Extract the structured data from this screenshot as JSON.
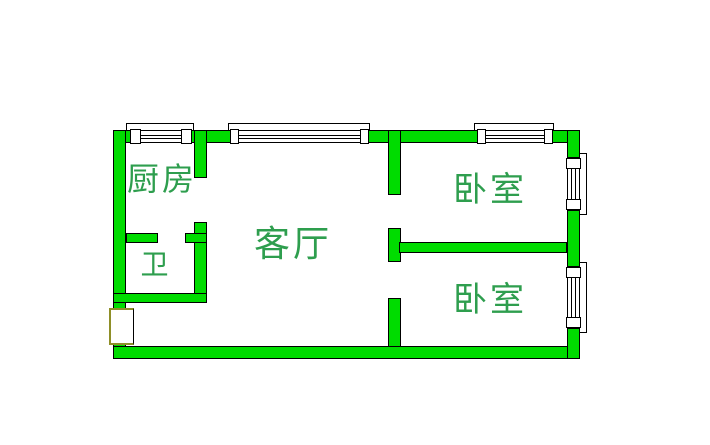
{
  "floorplan": {
    "rooms": [
      {
        "id": "kitchen",
        "label": "厨房"
      },
      {
        "id": "living_room",
        "label": "客厅"
      },
      {
        "id": "bathroom",
        "label": "卫"
      },
      {
        "id": "bedroom_top",
        "label": "卧室"
      },
      {
        "id": "bedroom_bottom",
        "label": "卧室"
      }
    ],
    "colors": {
      "background": "#FFFFFF",
      "wall_fill": "#00DC00",
      "wall_outline": "#000000",
      "window_fill": "#FFFFFF",
      "label_text": "#2E9E4E",
      "door_frame": "#8F8F28"
    }
  }
}
